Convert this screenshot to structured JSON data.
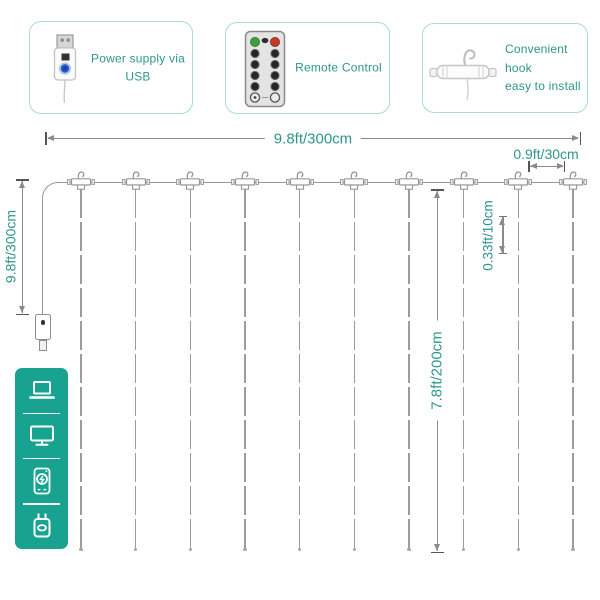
{
  "callouts": [
    {
      "icon": "usb-plug-icon",
      "label": "Power supply via USB"
    },
    {
      "icon": "remote-control-icon",
      "label": "Remote Control"
    },
    {
      "icon": "hook-icon",
      "label_line1": "Convenient hook",
      "label_line2": "easy to install"
    }
  ],
  "dimensions": {
    "curtain_width": "9.8ft/300cm",
    "hook_spacing": "0.9ft/30cm",
    "lead_cable_length": "9.8ft/300cm",
    "bulb_spacing": "0.33ft/10cm",
    "curtain_height": "7.8ft/200cm"
  },
  "curtain": {
    "strand_count": 10
  },
  "power_sources": {
    "icons": [
      "laptop-icon",
      "monitor-icon",
      "power-bank-icon",
      "usb-wall-charger-icon"
    ]
  },
  "colors": {
    "accent_teal": "#2E968B",
    "panel_teal": "#18A390",
    "callout_border": "#A9DCD4",
    "wire_gray": "#979797"
  }
}
